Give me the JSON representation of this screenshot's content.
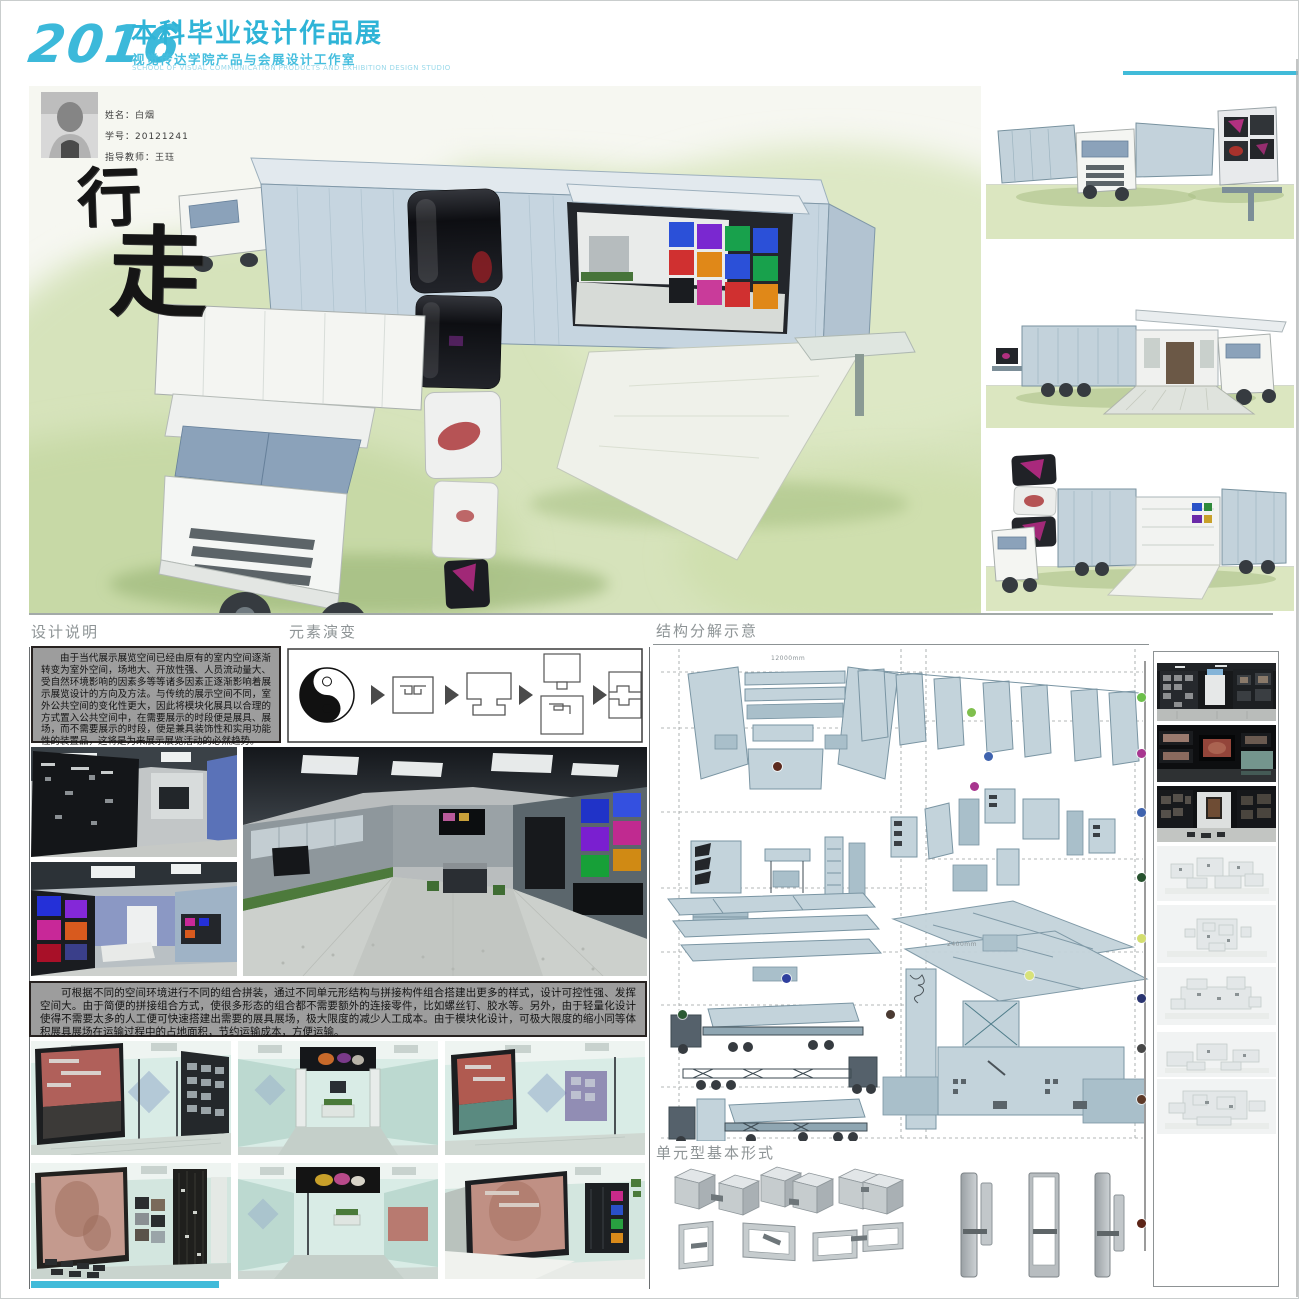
{
  "header": {
    "year": "2016",
    "title": "本科毕业设计作品展",
    "subtitle": "视觉传达学院产品与会展设计工作室",
    "subtitle_en": "SCHOOL OF VISUAL COMMUNICATION PRODUCTS AND EXHIBITION DESIGN STUDIO"
  },
  "student": {
    "name": "姓名：白烟",
    "student_id": "学号：20121241",
    "advisor": "指导教师：王珏"
  },
  "poster_title": {
    "char1": "行",
    "char2": "走"
  },
  "design_notes": {
    "heading": "设计说明",
    "body": "由于当代展示展览空间已经由原有的室内空间逐渐转变为室外空间，场地大、开放性强、人员流动量大、受自然环境影响的因素多等等诸多因素正逐渐影响着展示展览设计的方向及方法。与传统的展示空间不同，室外公共空间的变化性更大，因此将模块化展具以合理的方式置入公共空间中，在需要展示的时段便是展具、展场，而不需要展示的时段，便是兼具装饰性和实用功能性的装置品，这将是为来展示展览活动的必然趋势。"
  },
  "element_evolution": {
    "heading": "元素演变"
  },
  "structure": {
    "heading": "结构分解示意",
    "dim_top": "12000mm",
    "dim_right": "2400mm",
    "markers": [
      {
        "x": 776,
        "y": 765,
        "c": "#5c2a1e"
      },
      {
        "x": 970,
        "y": 711,
        "c": "#7fbf4d"
      },
      {
        "x": 987,
        "y": 755,
        "c": "#3f63ae"
      },
      {
        "x": 973,
        "y": 785,
        "c": "#a8368f"
      },
      {
        "x": 785,
        "y": 977,
        "c": "#2f3f9e"
      },
      {
        "x": 1028,
        "y": 974,
        "c": "#d8e27a"
      },
      {
        "x": 681,
        "y": 1013,
        "c": "#2c5a33"
      },
      {
        "x": 889,
        "y": 1013,
        "c": "#4a3a32"
      }
    ]
  },
  "assembly_notes": {
    "body": "可根据不同的空间环境进行不同的组合拼装，通过不同单元形结构与拼接构件组合搭建出更多的样式，设计可控性强、发挥空间大。由于简便的拼接组合方式，使很多形态的组合都不需要额外的连接零件，比如螺丝钉、胶水等。另外，由于轻量化设计使得不需要太多的人工便可快速搭建出需要的展具展场，极大限度的减少人工成本。由于模块化设计，可极大限度的缩小同等体积展具展场在运输过程中的占地面积，节约运输成本，方便运输。"
  },
  "unit_forms": {
    "heading": "单元型基本形式"
  },
  "colors": {
    "accent": "#41bbd9"
  },
  "timeline": {
    "x": 1140,
    "dots": [
      {
        "y": 696,
        "c": "#6cbf4a"
      },
      {
        "y": 752,
        "c": "#a8368f"
      },
      {
        "y": 811,
        "c": "#3f63ae"
      },
      {
        "y": 876,
        "c": "#27522e"
      },
      {
        "y": 937,
        "c": "#d3de6e"
      },
      {
        "y": 997,
        "c": "#2a3470"
      },
      {
        "y": 1047,
        "c": "#474747"
      },
      {
        "y": 1098,
        "c": "#5e3a28"
      },
      {
        "y": 1222,
        "c": "#5c2417"
      }
    ]
  }
}
